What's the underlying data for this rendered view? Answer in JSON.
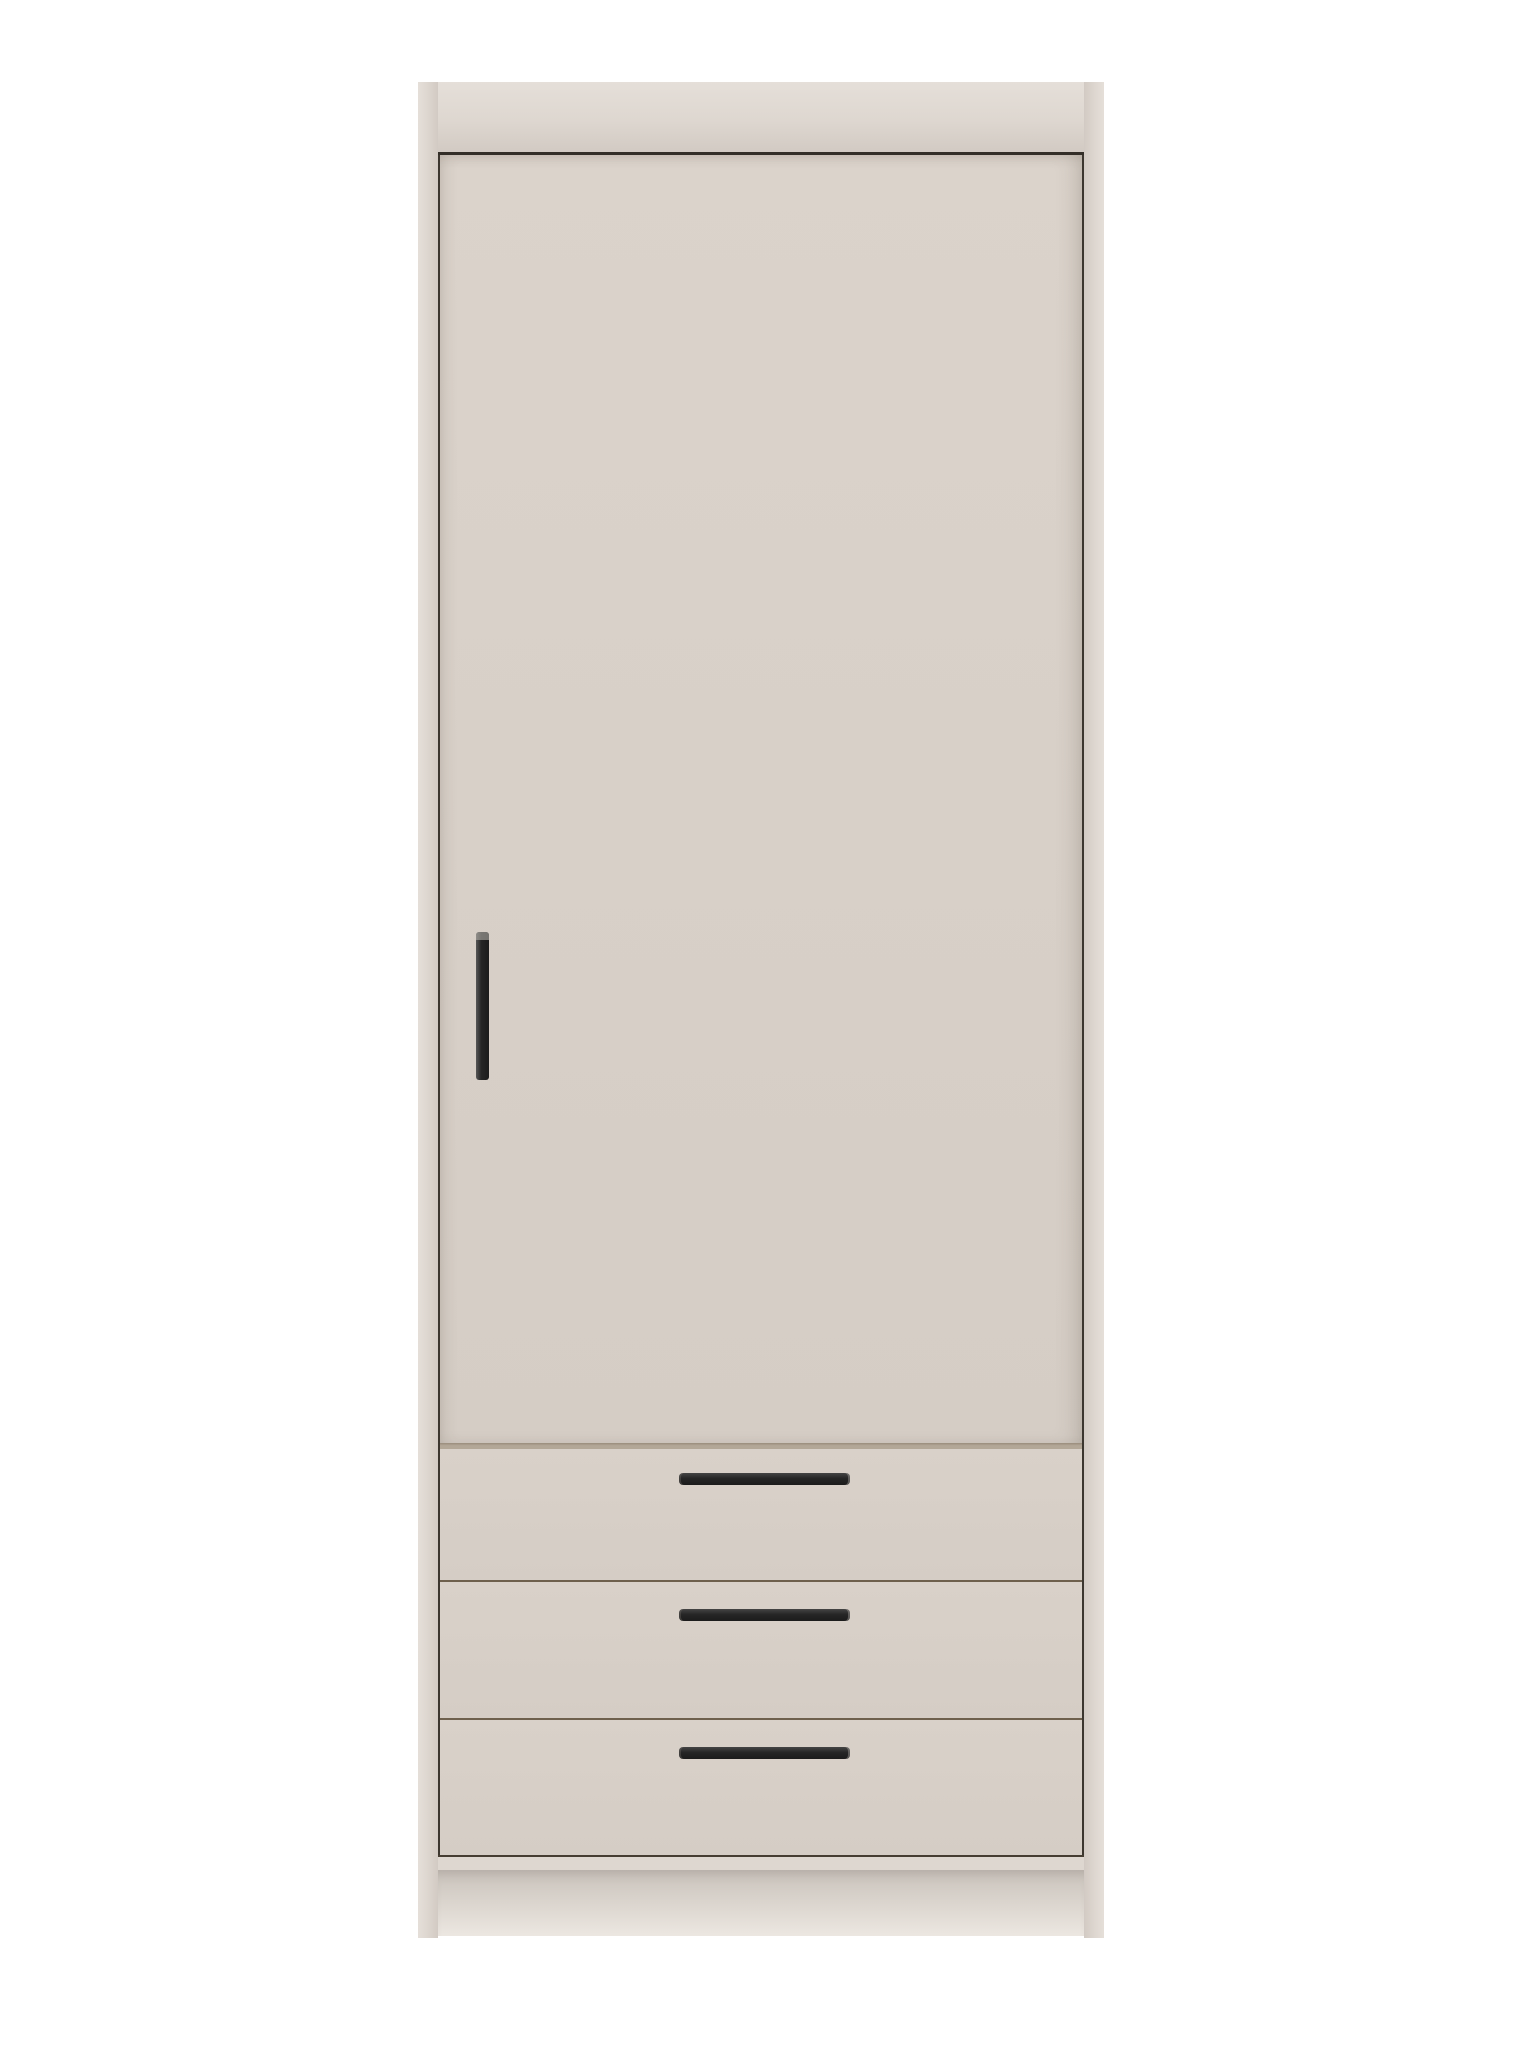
{
  "scene": {
    "kind": "product-photo",
    "object": "wardrobe",
    "description": "Tall single-door wardrobe with three bottom drawers, greige finish, black bar handles, plain white studio background",
    "door_count": 1,
    "drawer_count": 3,
    "background": "#ffffff"
  },
  "colors": {
    "background": "#ffffff",
    "frame": "#ded7d0",
    "frame_light": "#e5dfd9",
    "frame_dark": "#d2cac3",
    "door_top": "#dbd3cb",
    "door_bottom": "#d5cdc5",
    "drawer_face": "#d9d1c9",
    "seam_top": "#332e28",
    "seam_vertical": "#3c362f",
    "seam_drawer": "#6e604d",
    "seam_bottom": "#463d32",
    "groove": "#b3a797",
    "groove_dark": "#998c7c",
    "handle": "#262626",
    "handle_highlight": "#575757",
    "plinth_dark": "#c9c2bb",
    "plinth_mid": "#d9d3cc",
    "plinth_light": "#ece7e1"
  },
  "drawers": [
    {
      "name": "drawer-1",
      "height": 131,
      "handle_top": 24
    },
    {
      "name": "drawer-2",
      "height": 136,
      "handle_top": 27
    },
    {
      "name": "drawer-3",
      "height": 135,
      "handle_top": 27
    }
  ]
}
